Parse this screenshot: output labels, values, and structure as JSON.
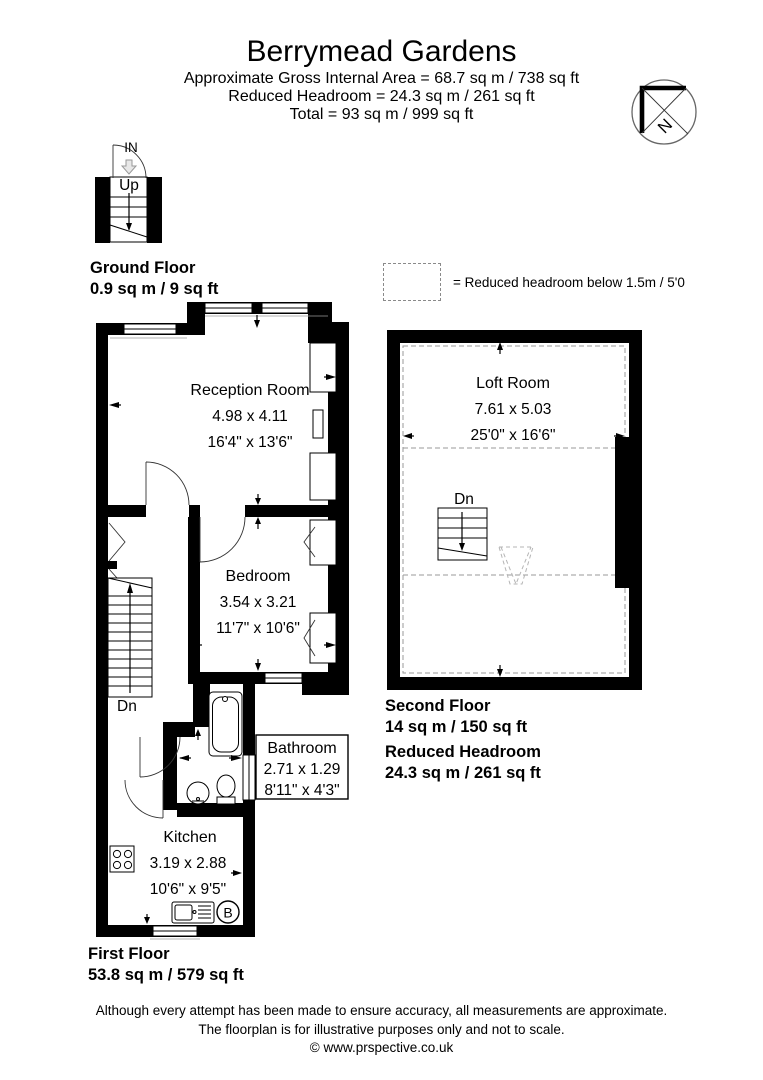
{
  "header": {
    "title": "Berrymead Gardens",
    "line1": "Approximate Gross Internal Area = 68.7 sq m / 738 sq ft",
    "line2": "Reduced Headroom = 24.3 sq m / 261 sq ft",
    "line3": "Total = 93 sq m / 999 sq ft"
  },
  "compass": {
    "label": "N"
  },
  "legend": {
    "text": "= Reduced headroom below 1.5m / 5'0"
  },
  "ground_floor": {
    "in_label": "IN",
    "up_label": "Up",
    "name": "Ground Floor",
    "area": "0.9 sq m / 9 sq ft"
  },
  "first_floor": {
    "name": "First Floor",
    "area": "53.8 sq m / 579 sq ft",
    "stairs_label": "Dn",
    "boiler_label": "B",
    "reception": {
      "name": "Reception Room",
      "metric": "4.98 x 4.11",
      "imperial": "16'4\" x 13'6\""
    },
    "bedroom": {
      "name": "Bedroom",
      "metric": "3.54 x 3.21",
      "imperial": "11'7\" x 10'6\""
    },
    "bathroom": {
      "name": "Bathroom",
      "metric": "2.71 x 1.29",
      "imperial": "8'11\" x 4'3\""
    },
    "kitchen": {
      "name": "Kitchen",
      "metric": "3.19 x 2.88",
      "imperial": "10'6\" x 9'5\""
    }
  },
  "second_floor": {
    "name": "Second Floor",
    "area": "14 sq m / 150 sq ft",
    "reduced_label": "Reduced Headroom",
    "reduced_area": "24.3 sq m / 261 sq ft",
    "stairs_label": "Dn",
    "loft": {
      "name": "Loft Room",
      "metric": "7.61 x 5.03",
      "imperial": "25'0\" x 16'6\""
    }
  },
  "footer": {
    "line1": "Although every attempt has been made to ensure accuracy, all measurements are approximate.",
    "line2": "The floorplan is for illustrative purposes only and not to scale.",
    "line3": "© www.prspective.co.uk"
  },
  "colors": {
    "wall": "#000000",
    "dashed_headroom": "#999999",
    "background": "#ffffff"
  }
}
